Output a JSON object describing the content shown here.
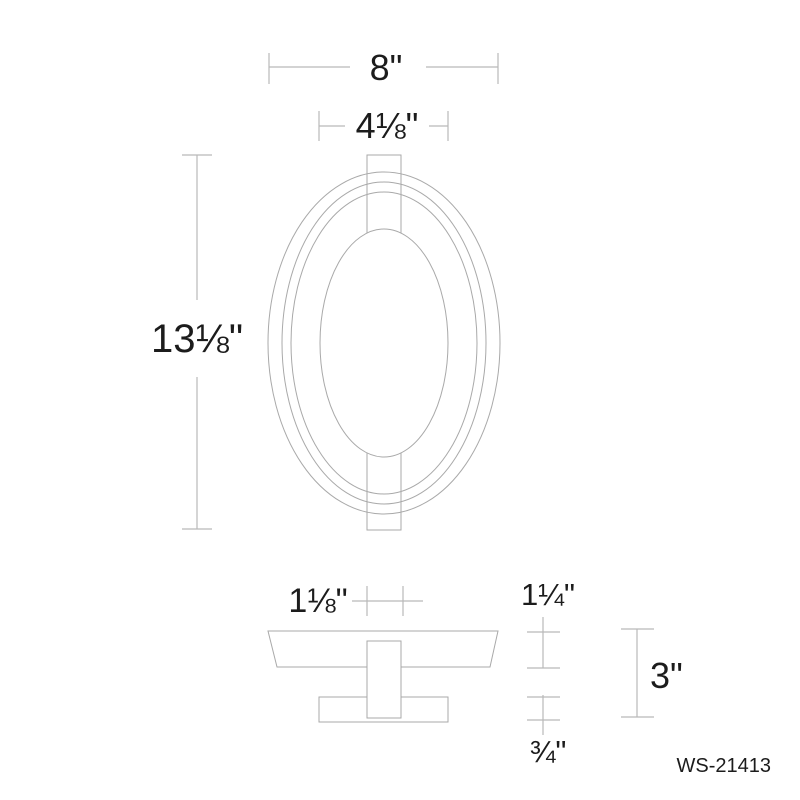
{
  "drawing": {
    "product_code": "WS-21413",
    "dimensions": {
      "overall_width": "8\"",
      "backplate_width": "4⅛\"",
      "overall_height": "13⅛\"",
      "stem_width": "1⅛\"",
      "ring_depth": "1¼\"",
      "overall_depth": "3\"",
      "backplate_depth": "¾\""
    },
    "colors": {
      "background": "#ffffff",
      "shape_line": "#a9a9a9",
      "dimension_line": "#b9b9b9",
      "text": "#1c1c1c"
    }
  }
}
